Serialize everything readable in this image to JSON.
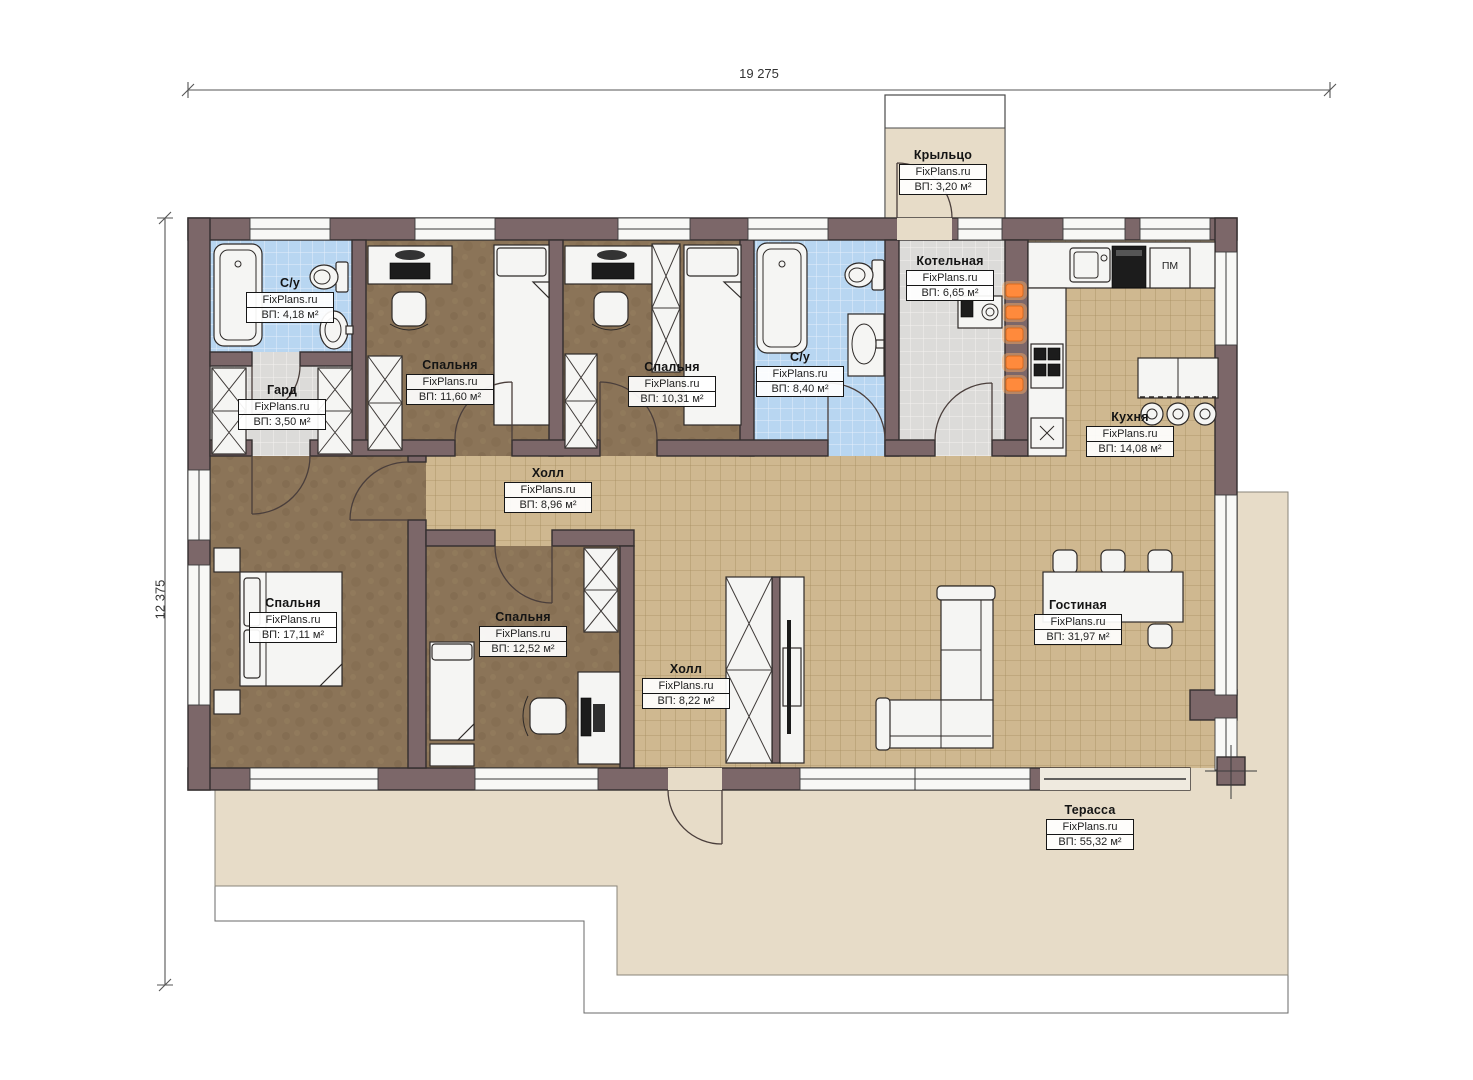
{
  "plan": {
    "dimensions": {
      "width": "19 275",
      "height": "12 375"
    },
    "rooms": [
      {
        "name": "Крыльцо",
        "brand": "FixPlans.ru",
        "area": "ВП: 3,20 м²"
      },
      {
        "name": "С/у",
        "brand": "FixPlans.ru",
        "area": "ВП: 4,18 м²"
      },
      {
        "name": "Гард",
        "brand": "FixPlans.ru",
        "area": "ВП: 3,50 м²"
      },
      {
        "name": "Спальня",
        "brand": "FixPlans.ru",
        "area": "ВП: 11,60 м²"
      },
      {
        "name": "Спальня",
        "brand": "FixPlans.ru",
        "area": "ВП: 10,31 м²"
      },
      {
        "name": "С/у",
        "brand": "FixPlans.ru",
        "area": "ВП: 8,40 м²"
      },
      {
        "name": "Котельная",
        "brand": "FixPlans.ru",
        "area": "ВП: 6,65 м²"
      },
      {
        "name": "Кухня",
        "brand": "FixPlans.ru",
        "area": "ВП: 14,08 м²"
      },
      {
        "name": "Холл",
        "brand": "FixPlans.ru",
        "area": "ВП: 8,96 м²"
      },
      {
        "name": "Спальня",
        "brand": "FixPlans.ru",
        "area": "ВП: 17,11 м²"
      },
      {
        "name": "Спальня",
        "brand": "FixPlans.ru",
        "area": "ВП: 12,52 м²"
      },
      {
        "name": "Холл",
        "brand": "FixPlans.ru",
        "area": "ВП: 8,22 м²"
      },
      {
        "name": "Гостиная",
        "brand": "FixPlans.ru",
        "area": "ВП: 31,97 м²"
      },
      {
        "name": "Терасса",
        "brand": "FixPlans.ru",
        "area": "ВП: 55,32 м²"
      }
    ],
    "kitchen": {
      "dishwasher_label": "ПМ"
    },
    "colors": {
      "wall": "#7c6769",
      "floor_tile": "#cfb890",
      "bathroom_tile": "#b8d6f1",
      "utility_tile": "#dcdbd9",
      "bedroom_floor": "#8b7458",
      "terrace": "#e7dcc8",
      "radiator": "#ff8a3c"
    }
  }
}
